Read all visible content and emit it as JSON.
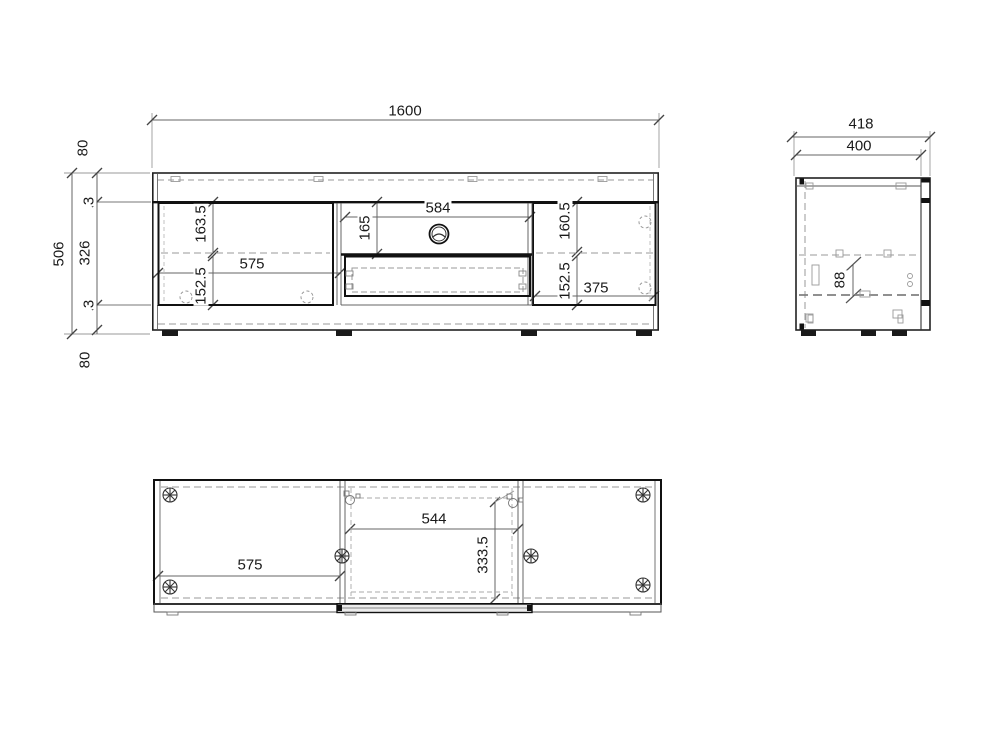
{
  "background": "#ffffff",
  "ink": "#1a1a1a",
  "drawing": {
    "front_view": {
      "total_width": "1600",
      "total_height": "506",
      "top_panel_height": "80",
      "top_gap": "3",
      "door_section_height": "326",
      "bottom_gap": "3",
      "bottom_panel_height": "80",
      "left_opening_width": "575",
      "left_upper_height": "163.5",
      "left_lower_height": "152.5",
      "niche_width": "584",
      "niche_height": "165",
      "right_upper_height": "160.5",
      "right_lower_height": "152.5",
      "right_opening_width": "375"
    },
    "side_view": {
      "total_depth": "418",
      "body_depth": "400",
      "detail_height": "88"
    },
    "plan_view": {
      "niche_width": "544",
      "left_opening_width": "575",
      "inner_depth": "333.5"
    }
  }
}
